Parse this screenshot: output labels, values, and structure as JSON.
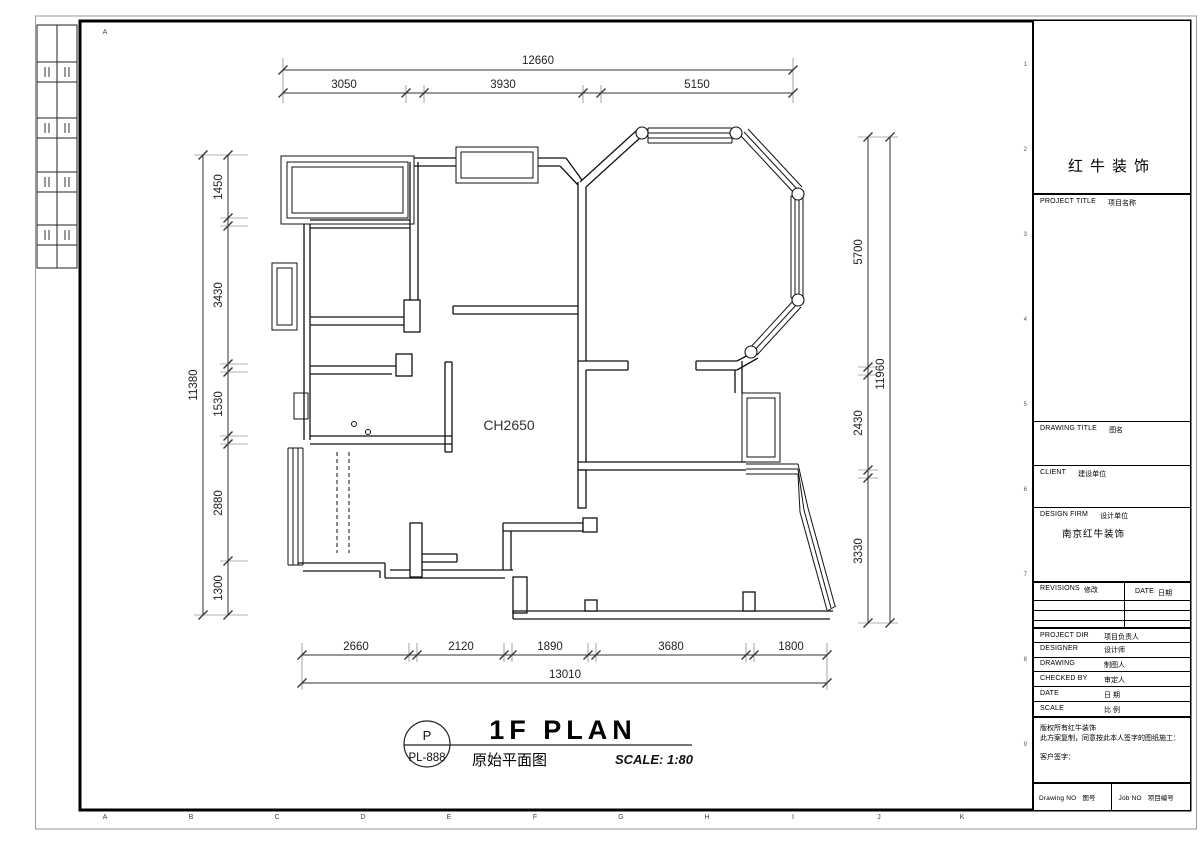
{
  "sheet": {
    "grid_letter_top": "A",
    "grid_letters_bottom": [
      "A",
      "B",
      "C",
      "D",
      "E",
      "F",
      "G",
      "H",
      "I",
      "J",
      "K"
    ],
    "grid_numbers_right": [
      "1",
      "2",
      "3",
      "4",
      "5",
      "6",
      "7",
      "8",
      "9"
    ]
  },
  "plan": {
    "ceiling_height_label": "CH2650",
    "dims": {
      "top": {
        "total": "12660",
        "segments": [
          "3050",
          "3930",
          "5150"
        ]
      },
      "left": {
        "total": "11380",
        "segments": [
          "1450",
          "3430",
          "1530",
          "2880",
          "1300"
        ]
      },
      "right": {
        "total": "11960",
        "segments": [
          "5700",
          "2430",
          "3330"
        ]
      },
      "bottom": {
        "total": "13010",
        "segments": [
          "2660",
          "2120",
          "1890",
          "3680",
          "1800"
        ]
      }
    }
  },
  "title": {
    "code_letter": "P",
    "code": "PL-888",
    "name_en": "1F PLAN",
    "name_zh": "原始平面图",
    "scale": "SCALE: 1:80"
  },
  "title_block": {
    "brand": "红牛装饰",
    "project_title": {
      "en": "PROJECT TITLE",
      "zh": "项目名称"
    },
    "drawing_title": {
      "en": "DRAWING TITLE",
      "zh": "图名"
    },
    "client": {
      "en": "CLIENT",
      "zh": "建设单位"
    },
    "design_firm": {
      "en": "DESIGN FIRM",
      "zh": "设计单位",
      "value": "南京红牛装饰"
    },
    "revisions": {
      "en": "REVISIONS",
      "zh": "修改"
    },
    "date_col": {
      "en": "DATE",
      "zh": "日期"
    },
    "project_dir": {
      "en": "PROJECT DIR",
      "zh": "项目负责人"
    },
    "designer": {
      "en": "DESIGNER",
      "zh": "设计师"
    },
    "drawing": {
      "en": "DRAWING",
      "zh": "制图人"
    },
    "checked_by": {
      "en": "CHECKED BY",
      "zh": "审定人"
    },
    "date": {
      "en": "DATE",
      "zh": "日 期"
    },
    "scale": {
      "en": "SCALE",
      "zh": "比 例"
    },
    "notes": {
      "line1": "版权所有红牛装饰",
      "line2": "此方案复制，同意按此本人签字的图纸施工：",
      "sign": "客户签字："
    },
    "drawing_no": {
      "en": "Drawing NO",
      "zh": "图号"
    },
    "job_no": {
      "en": "Job NO",
      "zh": "项目编号"
    }
  }
}
